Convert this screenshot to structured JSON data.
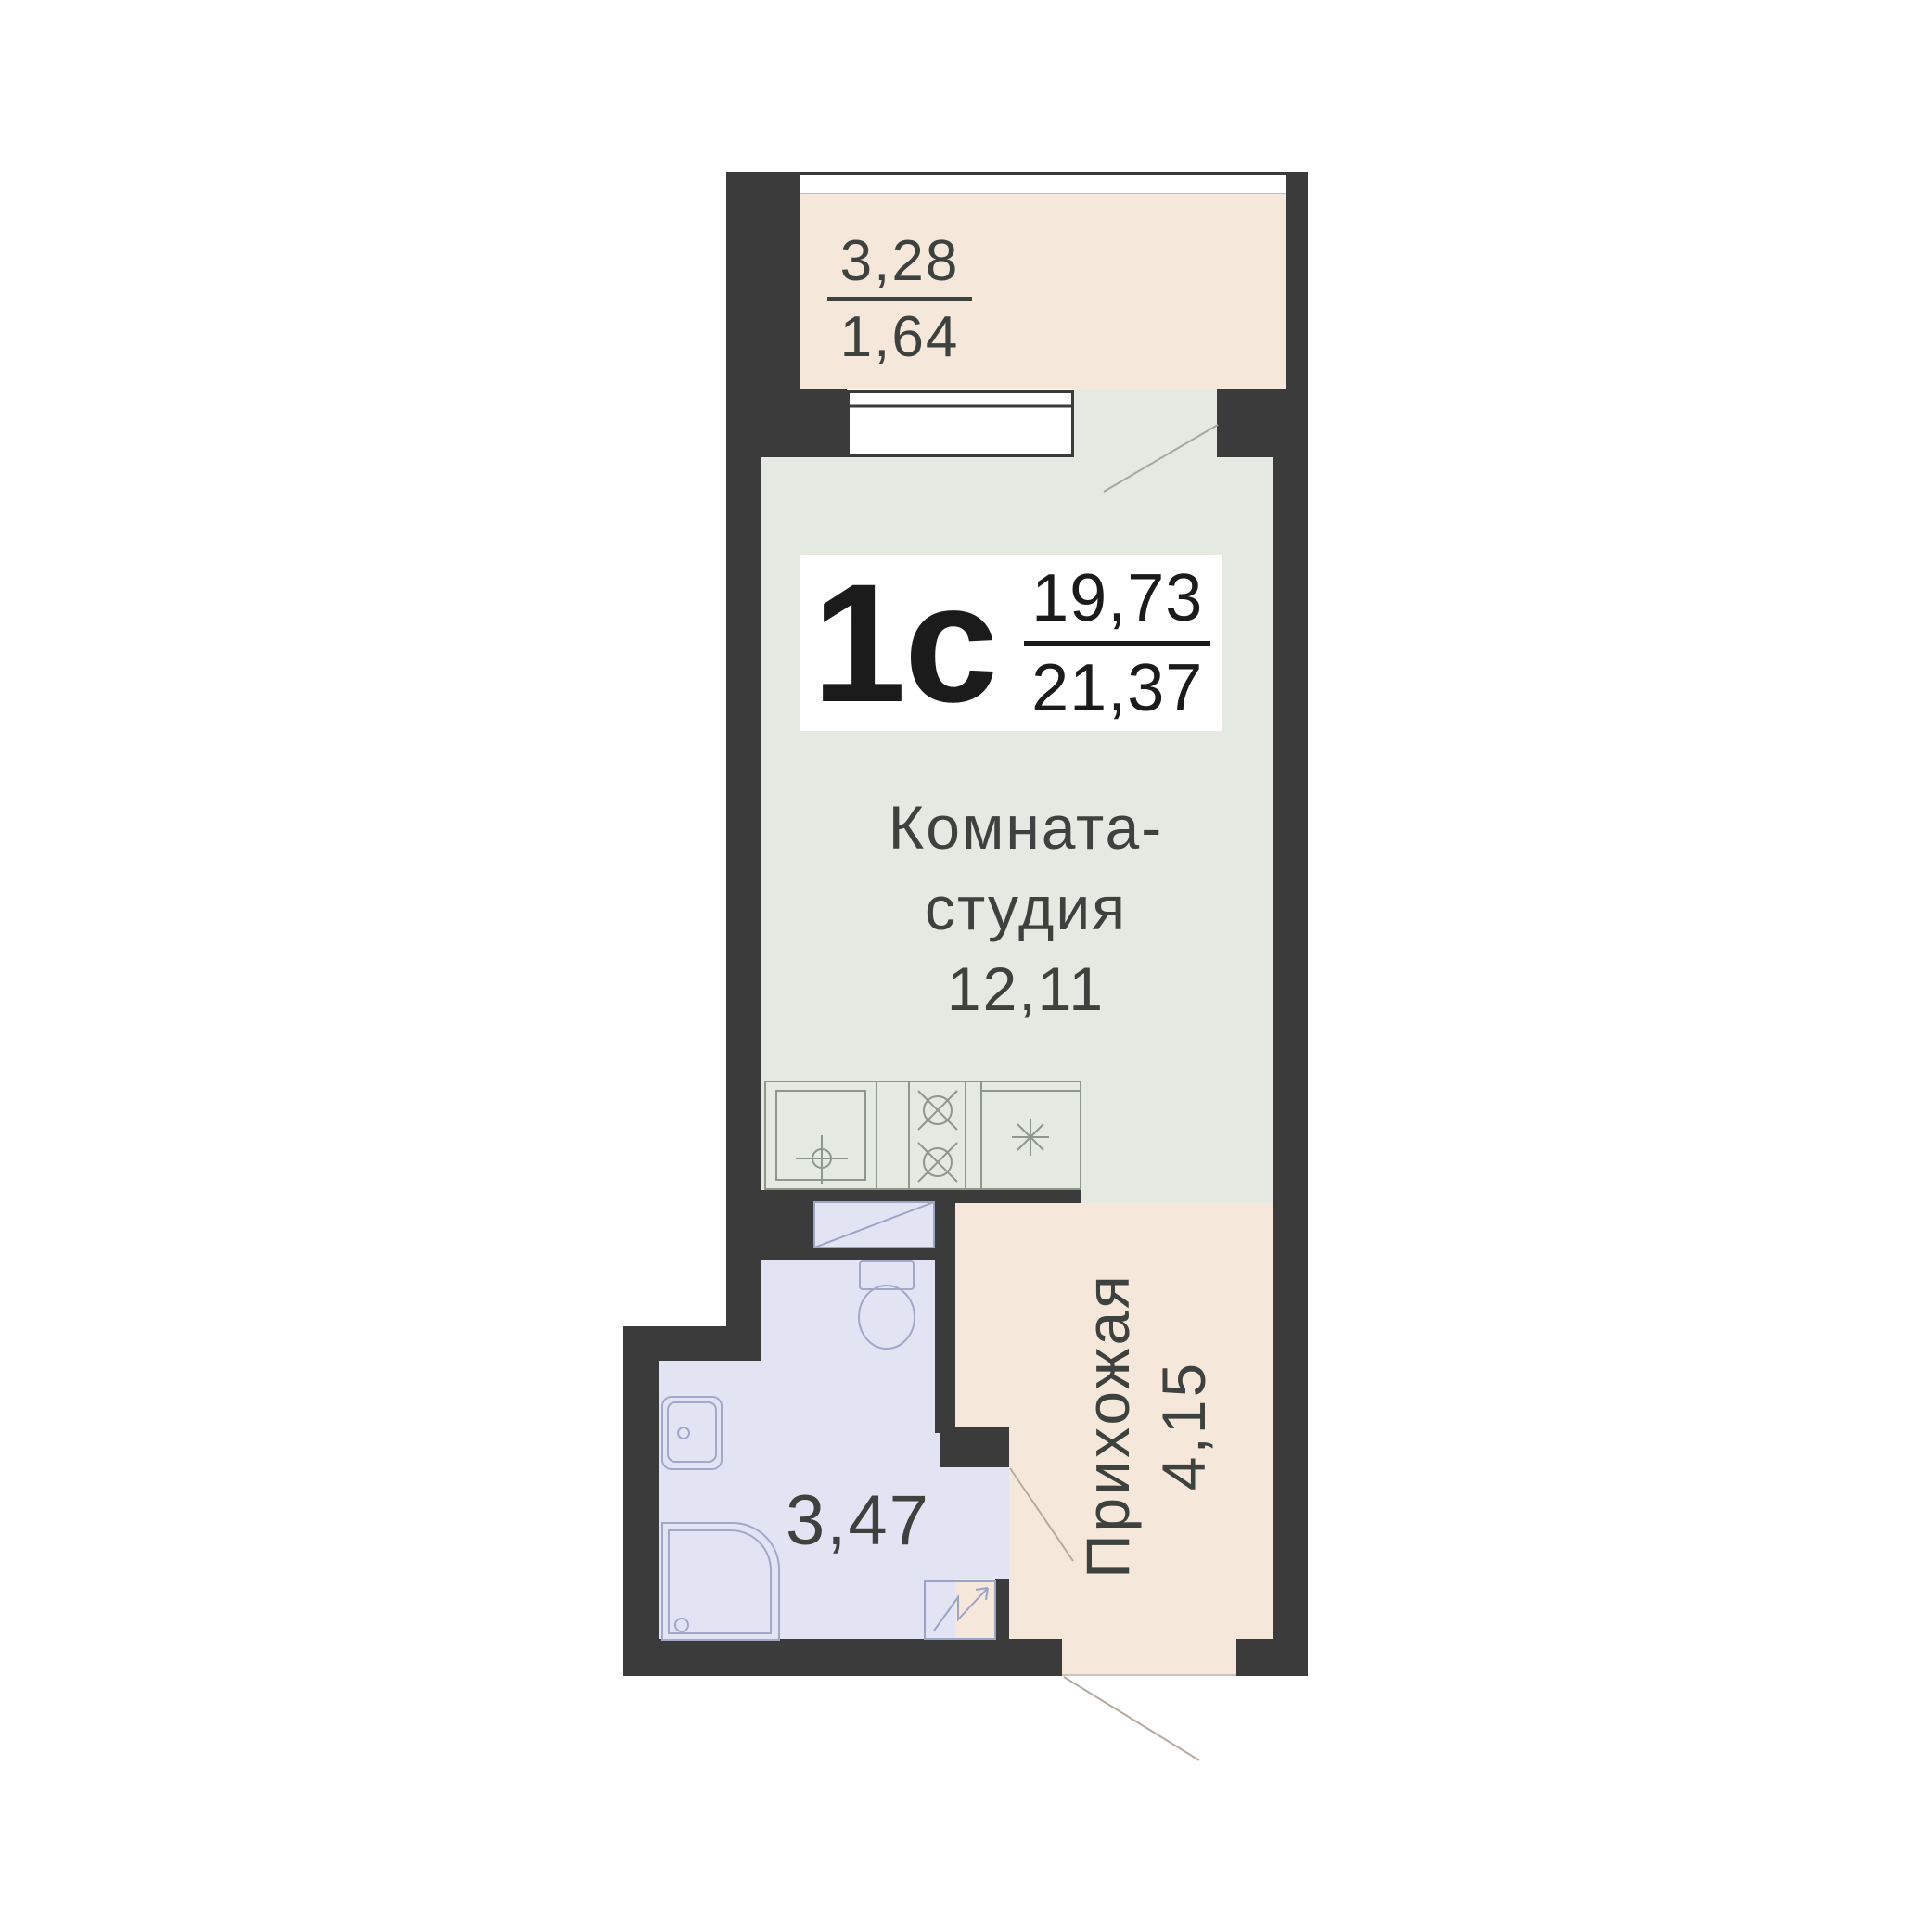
{
  "unit": {
    "type_label": "1с",
    "area_living": "19,73",
    "area_total": "21,37"
  },
  "rooms": {
    "balcony": {
      "area_full": "3,28",
      "area_reduced": "1,64"
    },
    "studio": {
      "name_line1": "Комната-",
      "name_line2": "студия",
      "area": "12,11"
    },
    "bathroom": {
      "area": "3,47"
    },
    "hallway": {
      "name": "Прихожая",
      "area": "4,15"
    }
  },
  "fixtures": [
    "kitchen-sink",
    "stove-two-burners",
    "fridge",
    "washing-machine",
    "toilet",
    "bathroom-sink",
    "shower-cabin",
    "water-heater"
  ],
  "colors": {
    "wall": "#3b3b3b",
    "balcony_floor": "#f6e7db",
    "hallway_floor": "#f6e7db",
    "room_floor": "#e4e9e1",
    "bathroom_floor": "#e2e4f3",
    "label_text": "#3e423f",
    "unit_text": "#1b1b1b"
  }
}
